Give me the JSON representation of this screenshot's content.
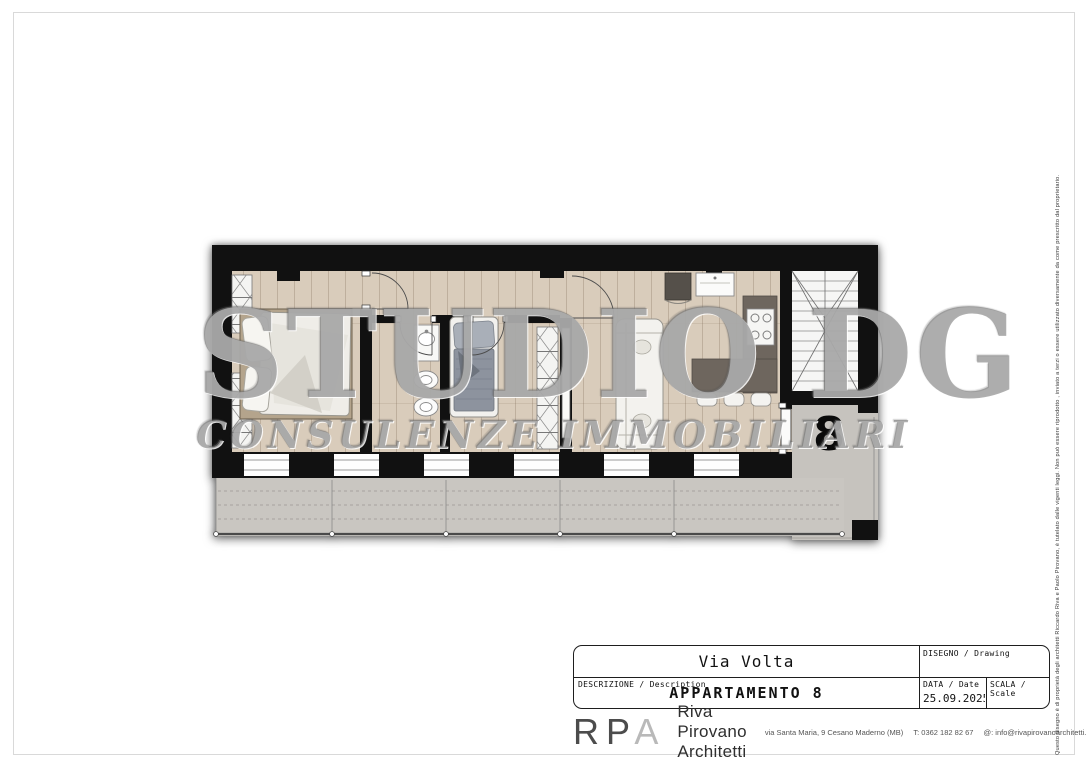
{
  "page": {
    "disclaimer": "Questo disegno è di proprietà degli architetti Riccardo Riva e Paolo Pirovano, è tutelato dalle vigenti leggi. Non può essere riprodotto , inviato a terzi o essere utilizzato diversamente da come prescritto dal proprietario."
  },
  "plan": {
    "unit_number": "8",
    "watermark_line1": "STUDIO DG",
    "watermark_line2": "CONSULENZE IMMOBILIARI"
  },
  "title_block": {
    "street": "Via Volta",
    "drawing_label": "DISEGNO / Drawing",
    "description_label": "DESCRIZIONE / Description",
    "description_value": "APPARTAMENTO 8",
    "date_label": "DATA / Date",
    "date_value": "25.09.2025",
    "scale_label": "SCALA / Scale"
  },
  "firm": {
    "logo_letters": [
      "R",
      "P",
      "A"
    ],
    "name": "Riva Pirovano Architetti",
    "address": "via Santa Maria, 9 Cesano Maderno (MB)",
    "phone": "T: 0362 182 82 67",
    "email": "@: info@rivapirovanoarchitetti.com"
  },
  "colors": {
    "wall": "#111111",
    "floor_wood": "#d8cbba",
    "balcony": "#c9c6c1",
    "kitchen_counter": "#6e665e",
    "watermark": "#7d7d7d",
    "sheet_frame": "#d9d9d9"
  }
}
